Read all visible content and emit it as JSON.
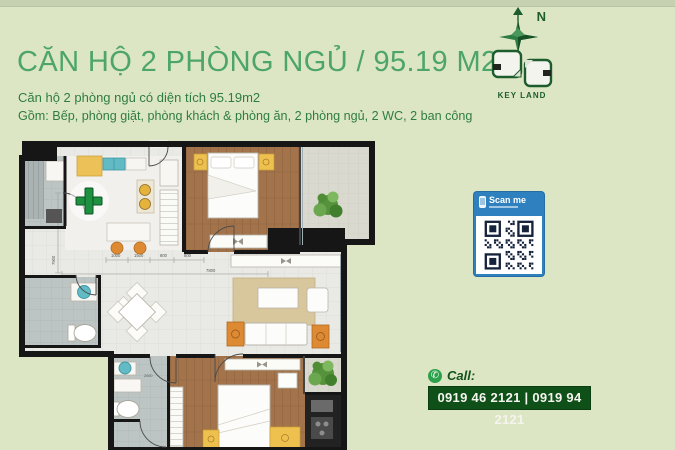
{
  "header": {
    "title": "CĂN HỘ 2 PHÒNG NGỦ / 95.19 M2",
    "subtitle": "Căn hộ 2 phòng ngủ có diện tích 95.19m2",
    "description": "Gồm: Bếp, phòng giặt, phòng khách & phòng ăn, 2 phòng ngủ, 2 WC, 2 ban công"
  },
  "compass": {
    "north_label": "N"
  },
  "brand": {
    "name": "KEY LAND"
  },
  "qr_badge": {
    "title": "Scan me"
  },
  "contact": {
    "call_label": "Call:",
    "phone_icon": "✆",
    "phones": "0919 46 2121 | 0919 94 2121"
  },
  "floorplan": {
    "dims": {
      "d1": "1000",
      "d2": "1500",
      "d3": "800",
      "d4": "800",
      "width_total": "7800",
      "height_total": "7900",
      "bed1": "4700",
      "console": "4700",
      "bath2": "2000"
    }
  },
  "colors": {
    "background": "#dce6c4",
    "top_strip": "#c6d1b2",
    "title_green": "#4da56a",
    "text_green": "#2f7c42",
    "brand_green": "#1c5c2d",
    "qr_blue": "#2e80bf",
    "phone_box": "#0f5019",
    "accent_plus": "#1d9140",
    "wood": "#a3744c",
    "tile": "#e9e9e5",
    "wet_room": "#bdc5c4",
    "furniture_yellow": "#eec14e",
    "furniture_orange": "#dd8a33",
    "fixture_teal": "#62bac4"
  }
}
